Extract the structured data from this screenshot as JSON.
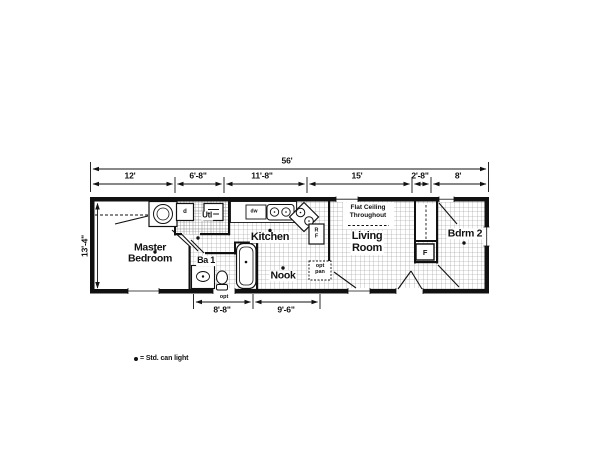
{
  "floor_plan": {
    "dimensions": {
      "overall_width": "56'",
      "height": "13'-4\"",
      "top_segments": [
        "12'",
        "6'-8\"",
        "11'-8\"",
        "15'",
        "2'-8\"",
        "8'"
      ],
      "bottom_segments": [
        "8'-8\"",
        "9'-6\""
      ]
    },
    "rooms": {
      "master_bedroom": "Master\nBedroom",
      "bath": "Ba 1",
      "utility": "Utl",
      "kitchen": "Kitchen",
      "nook": "Nook",
      "living_room": "Living\nRoom",
      "bedroom2": "Bdrm 2"
    },
    "labels": {
      "flat_ceiling": "Flat Ceiling\nThroughout",
      "optional_pantry": "opt\npan",
      "optional_door": "opt",
      "dishwasher": "dw",
      "dryer": "d",
      "refrigerator": "RF",
      "furnace": "F"
    },
    "legend": {
      "can_light": "= Std. can light"
    },
    "colors": {
      "wall": "#111111",
      "grid_line": "#8f8f8f",
      "background": "#ffffff"
    }
  }
}
